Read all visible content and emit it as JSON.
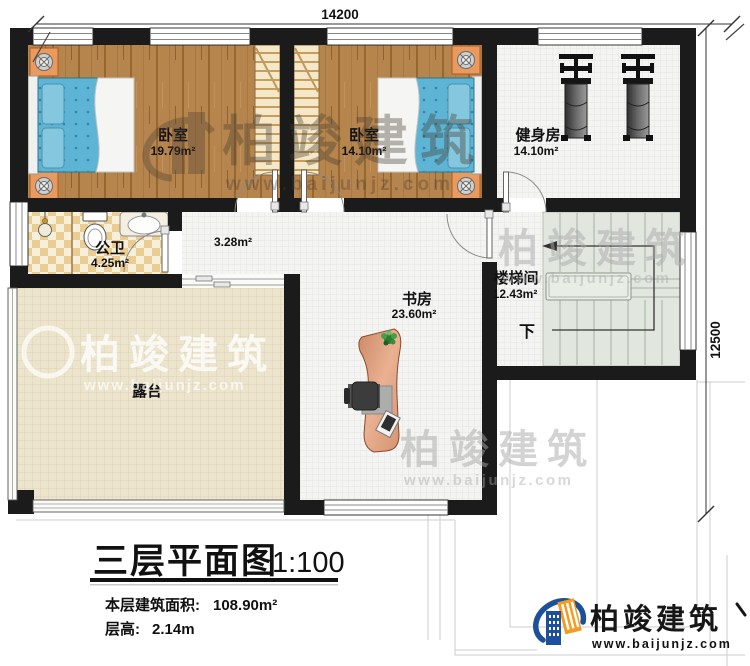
{
  "dimensions": {
    "width_mm": "14200",
    "depth_mm": "12500"
  },
  "rooms": {
    "bedroom_left": {
      "name": "卧室",
      "area": "19.79m²"
    },
    "bedroom_right": {
      "name": "卧室",
      "area": "14.10m²"
    },
    "gym": {
      "name": "健身房",
      "area": "14.10m²"
    },
    "bathroom": {
      "name": "公卫",
      "area": "4.25m²"
    },
    "hallway": {
      "area": "3.28m²"
    },
    "stairwell": {
      "name": "楼梯间",
      "area": "12.43m²",
      "direction_label": "下"
    },
    "study": {
      "name": "书房",
      "area": "23.60m²"
    },
    "terrace": {
      "name": "露台"
    }
  },
  "title_block": {
    "title": "三层平面图",
    "scale": "1:100",
    "area_label": "本层建筑面积:",
    "area_value": "108.90m²",
    "floor_height_label": "层高:",
    "floor_height_value": "2.14m"
  },
  "brand": {
    "name": "柏竣建筑",
    "url": "www.baijunjz.com"
  },
  "colors": {
    "wall": "#1b1b1b",
    "wood_floor": "#b5854d",
    "bed": "#5db4d4",
    "terrace_floor": "#ece4cd",
    "bathroom_tile": "#e9cd92",
    "stair_tread": "#e1e6de",
    "logo_blue": "#1c4f9c",
    "logo_orange": "#f59b20"
  }
}
